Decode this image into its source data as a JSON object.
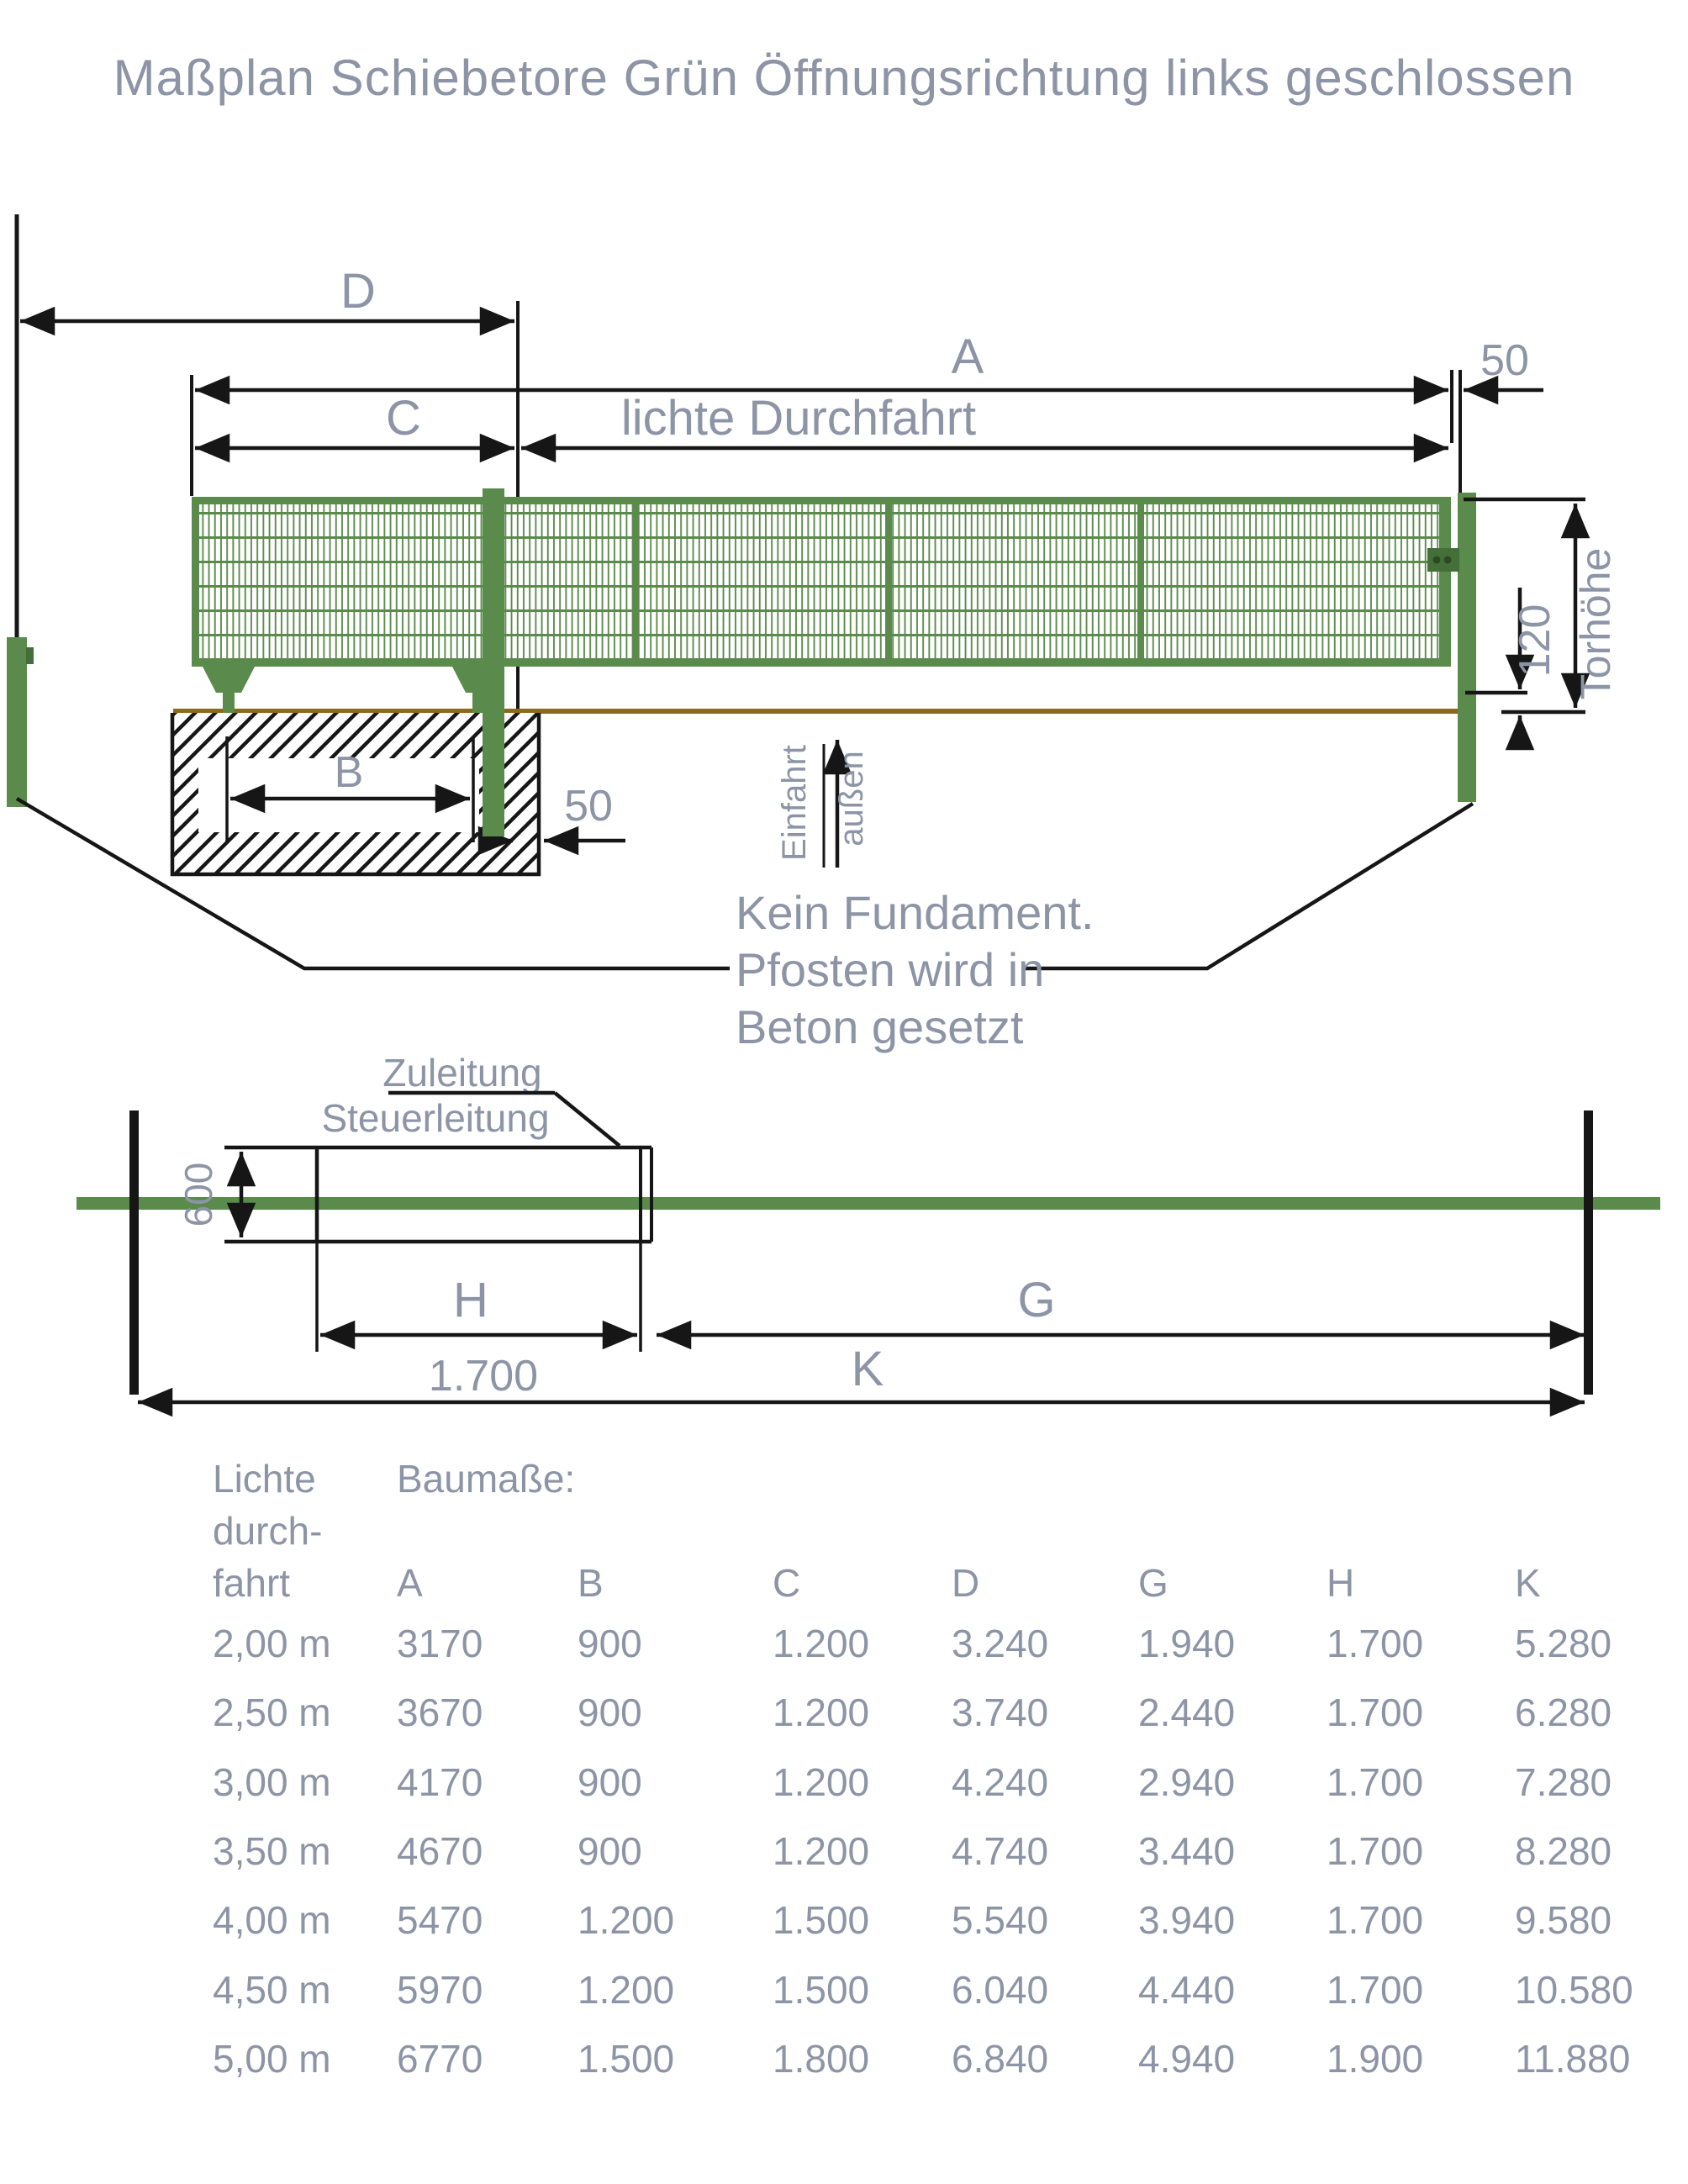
{
  "title": "Maßplan Schiebetore Grün Öffnungsrichtung links geschlossen",
  "colors": {
    "gate_green": "#5b8b4c",
    "dark_green": "#456f38",
    "label_gray": "#8c94a6",
    "ground_brown": "#8c6a1d",
    "line_black": "#161616"
  },
  "elevation": {
    "dim_d": "D",
    "dim_a": "A",
    "dim_c": "C",
    "dim_clear_width": "lichte Durchfahrt",
    "dim_gap_top": "50",
    "dim_gap_bottom": "50",
    "dim_b": "B",
    "dim_120": "120",
    "dim_gate_height": "Torhöhe",
    "arrow_left_label": "Einfahrt",
    "arrow_right_label": "außen",
    "note_line1": "Kein Fundament.",
    "note_line2": "Pfosten wird in",
    "note_line3": "Beton gesetzt"
  },
  "plan": {
    "lead_line1": "Zuleitung",
    "lead_line2": "Steuerleitung",
    "dim_600": "600",
    "dim_h": "H",
    "dim_h_value": "1.700",
    "dim_g": "G",
    "dim_k": "K"
  },
  "table": {
    "col1_header": [
      "Lichte",
      "durch-",
      "fahrt"
    ],
    "group_header": "Baumaße:",
    "columns": [
      "A",
      "B",
      "C",
      "D",
      "G",
      "H",
      "K"
    ],
    "rows": [
      [
        "2,00 m",
        "3170",
        "900",
        "1.200",
        "3.240",
        "1.940",
        "1.700",
        "5.280"
      ],
      [
        "2,50 m",
        "3670",
        "900",
        "1.200",
        "3.740",
        "2.440",
        "1.700",
        "6.280"
      ],
      [
        "3,00 m",
        "4170",
        "900",
        "1.200",
        "4.240",
        "2.940",
        "1.700",
        "7.280"
      ],
      [
        "3,50 m",
        "4670",
        "900",
        "1.200",
        "4.740",
        "3.440",
        "1.700",
        "8.280"
      ],
      [
        "4,00 m",
        "5470",
        "1.200",
        "1.500",
        "5.540",
        "3.940",
        "1.700",
        "9.580"
      ],
      [
        "4,50 m",
        "5970",
        "1.200",
        "1.500",
        "6.040",
        "4.440",
        "1.700",
        "10.580"
      ],
      [
        "5,00 m",
        "6770",
        "1.500",
        "1.800",
        "6.840",
        "4.940",
        "1.900",
        "11.880"
      ]
    ]
  }
}
